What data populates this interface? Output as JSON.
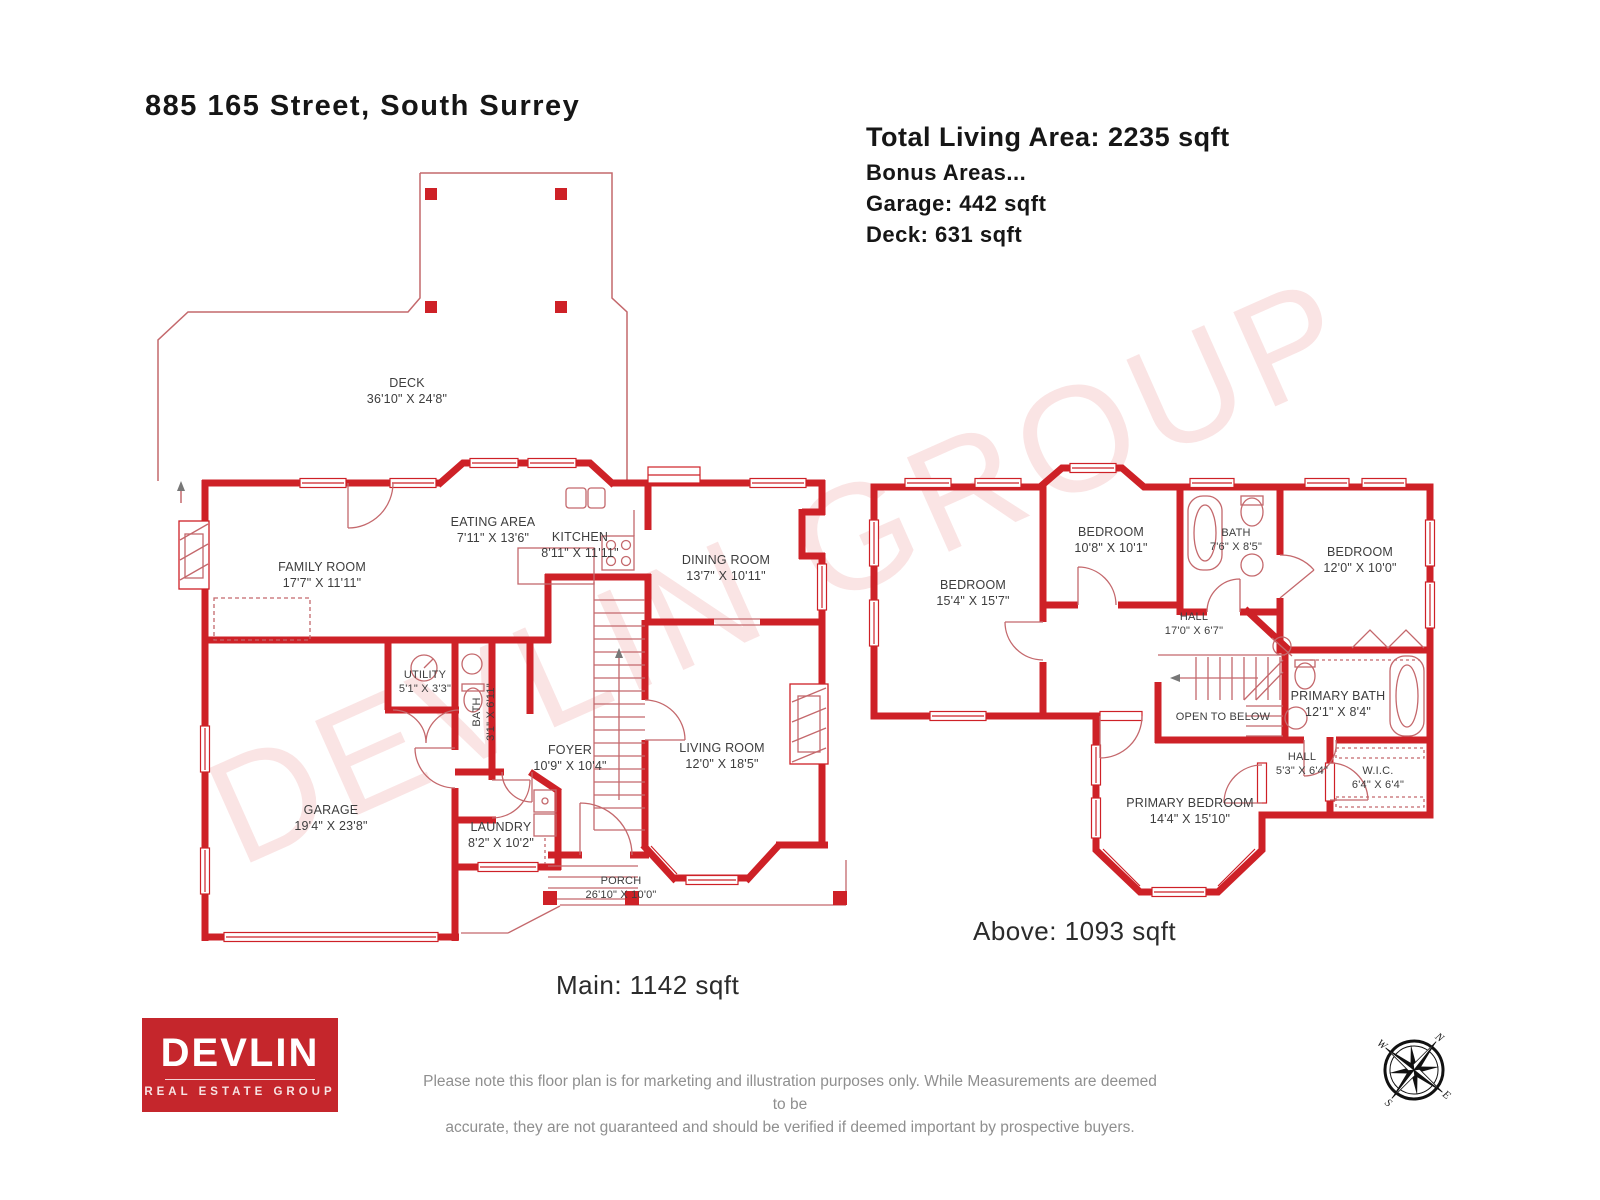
{
  "header": {
    "address": "885 165 Street, South Surrey",
    "total_living_area": "Total Living Area: 2235 sqft",
    "bonus_line": "Bonus Areas...",
    "garage_line": "Garage: 442 sqft",
    "deck_line": "Deck: 631 sqft"
  },
  "watermark": "DEVLIN GROUP",
  "main_floor": {
    "area_label": "Main: 1142 sqft",
    "rooms": [
      {
        "name": "DECK",
        "dims": "36'10\" X 24'8\""
      },
      {
        "name": "FAMILY ROOM",
        "dims": "17'7\" X 11'11\""
      },
      {
        "name": "EATING AREA",
        "dims": "7'11\" X 13'6\""
      },
      {
        "name": "KITCHEN",
        "dims": "8'11\" X 11'11\""
      },
      {
        "name": "DINING ROOM",
        "dims": "13'7\" X 10'11\""
      },
      {
        "name": "UTILITY",
        "dims": "5'1\" X 3'3\""
      },
      {
        "name": "BATH",
        "dims": "3'1\" X 6'11\""
      },
      {
        "name": "FOYER",
        "dims": "10'9\" X 10'4\""
      },
      {
        "name": "LIVING ROOM",
        "dims": "12'0\" X 18'5\""
      },
      {
        "name": "GARAGE",
        "dims": "19'4\" X 23'8\""
      },
      {
        "name": "LAUNDRY",
        "dims": "8'2\" X 10'2\""
      },
      {
        "name": "PORCH",
        "dims": "26'10\" X 10'0\""
      }
    ]
  },
  "upper_floor": {
    "area_label": "Above: 1093 sqft",
    "rooms": [
      {
        "name": "BEDROOM",
        "dims": "15'4\" X 15'7\""
      },
      {
        "name": "BEDROOM",
        "dims": "10'8\" X 10'1\""
      },
      {
        "name": "BATH",
        "dims": "7'6\" X 8'5\""
      },
      {
        "name": "BEDROOM",
        "dims": "12'0\" X 10'0\""
      },
      {
        "name": "HALL",
        "dims": "17'0\" X 6'7\""
      },
      {
        "name": "OPEN TO BELOW",
        "dims": ""
      },
      {
        "name": "PRIMARY BATH",
        "dims": "12'1\" X 8'4\""
      },
      {
        "name": "HALL",
        "dims": "5'3\" X 6'4\""
      },
      {
        "name": "W.I.C.",
        "dims": "6'4\" X 6'4\""
      },
      {
        "name": "PRIMARY BEDROOM",
        "dims": "14'4\" X 15'10\""
      }
    ]
  },
  "footer": {
    "logo_title": "DEVLIN",
    "logo_subtitle": "REAL ESTATE GROUP",
    "disclaimer_line1": "Please note this floor plan is for marketing and illustration purposes only. While Measurements are deemed to be",
    "disclaimer_line2": "accurate, they are not guaranteed and should be verified if deemed important by prospective buyers.",
    "compass": {
      "n": "N",
      "e": "E",
      "s": "S",
      "w": "W"
    }
  },
  "colors": {
    "wall_red": "#ce2127",
    "fixture_red": "#c4686c",
    "watermark_pink": "#f4d6d7",
    "logo_red": "#c5262c",
    "label_gray": "#3d3d3d",
    "disclaimer_gray": "#8f8f8f"
  }
}
